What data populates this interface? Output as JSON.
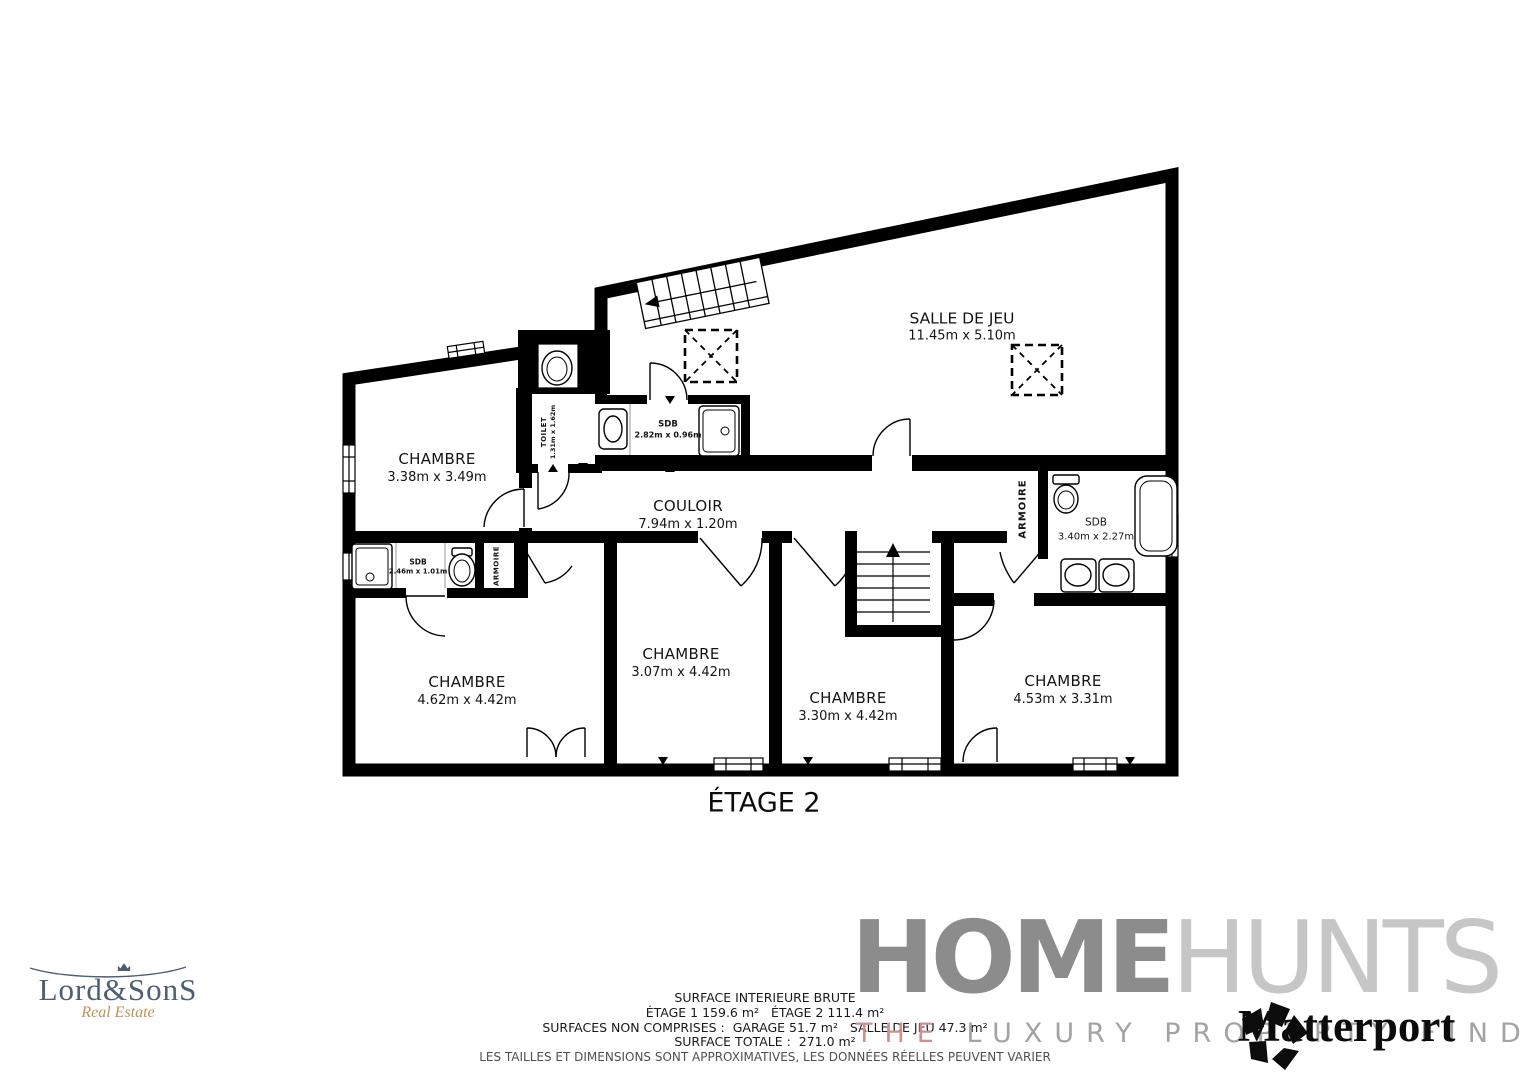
{
  "floor_plan": {
    "title": "ÉTAGE 2",
    "rooms": {
      "salle_de_jeu": {
        "name": "SALLE DE JEU",
        "dims": "11.45m x 5.10m"
      },
      "chambre_nw": {
        "name": "CHAMBRE",
        "dims": "3.38m x 3.49m"
      },
      "toilet": {
        "name": "TOILET",
        "dims": "1.31m x 1.62m"
      },
      "sdb_top": {
        "name": "SDB",
        "dims": "2.82m x 0.96m"
      },
      "couloir": {
        "name": "COULOIR",
        "dims": "7.94m x 1.20m"
      },
      "armoire_right": {
        "name": "ARMOIRE"
      },
      "sdb_right": {
        "name": "SDB",
        "dims": "3.40m x 2.27m"
      },
      "sdb_left": {
        "name": "SDB",
        "dims": "2.46m x 1.01m"
      },
      "armoire_left": {
        "name": "ARMOIRE"
      },
      "chambre_sw": {
        "name": "CHAMBRE",
        "dims": "4.62m x 4.42m"
      },
      "chambre_s1": {
        "name": "CHAMBRE",
        "dims": "3.07m x 4.42m"
      },
      "chambre_s2": {
        "name": "CHAMBRE",
        "dims": "3.30m x 4.42m"
      },
      "chambre_se": {
        "name": "CHAMBRE",
        "dims": "4.53m x 3.31m"
      }
    }
  },
  "footer": {
    "line1": "SURFACE INTERIEURE BRUTE",
    "line2": "ÉTAGE 1 159.6 m²   ÉTAGE 2 111.4 m²",
    "line3": "SURFACES NON COMPRISES :  GARAGE 51.7 m²   SALLE DE JEU 47.3 m²",
    "line4": "SURFACE TOTALE :  271.0 m²",
    "line5": "LES TAILLES ET DIMENSIONS SONT APPROXIMATIVES, LES DONNÉES RÉELLES PEUVENT VARIER"
  },
  "logos": {
    "lordsons": {
      "name": "Lord&SonS",
      "tagline": "Real Estate"
    },
    "homehunts": {
      "word1": "HOME",
      "word2": "HUNTS",
      "tagline_the": "THE",
      "tagline_rest": "LUXURY PROPERTY FINDERS"
    },
    "matterport": {
      "name": "Matterport"
    }
  },
  "colors": {
    "walls": "#000000",
    "homehunts_dark": "#8c8c8c",
    "homehunts_light": "#c6c6c6",
    "tagline_the": "#cf8f8f",
    "tagline_rest": "#a3a3a3",
    "lordsons_blue": "#4d5d73",
    "lordsons_gold": "#bd9459"
  }
}
